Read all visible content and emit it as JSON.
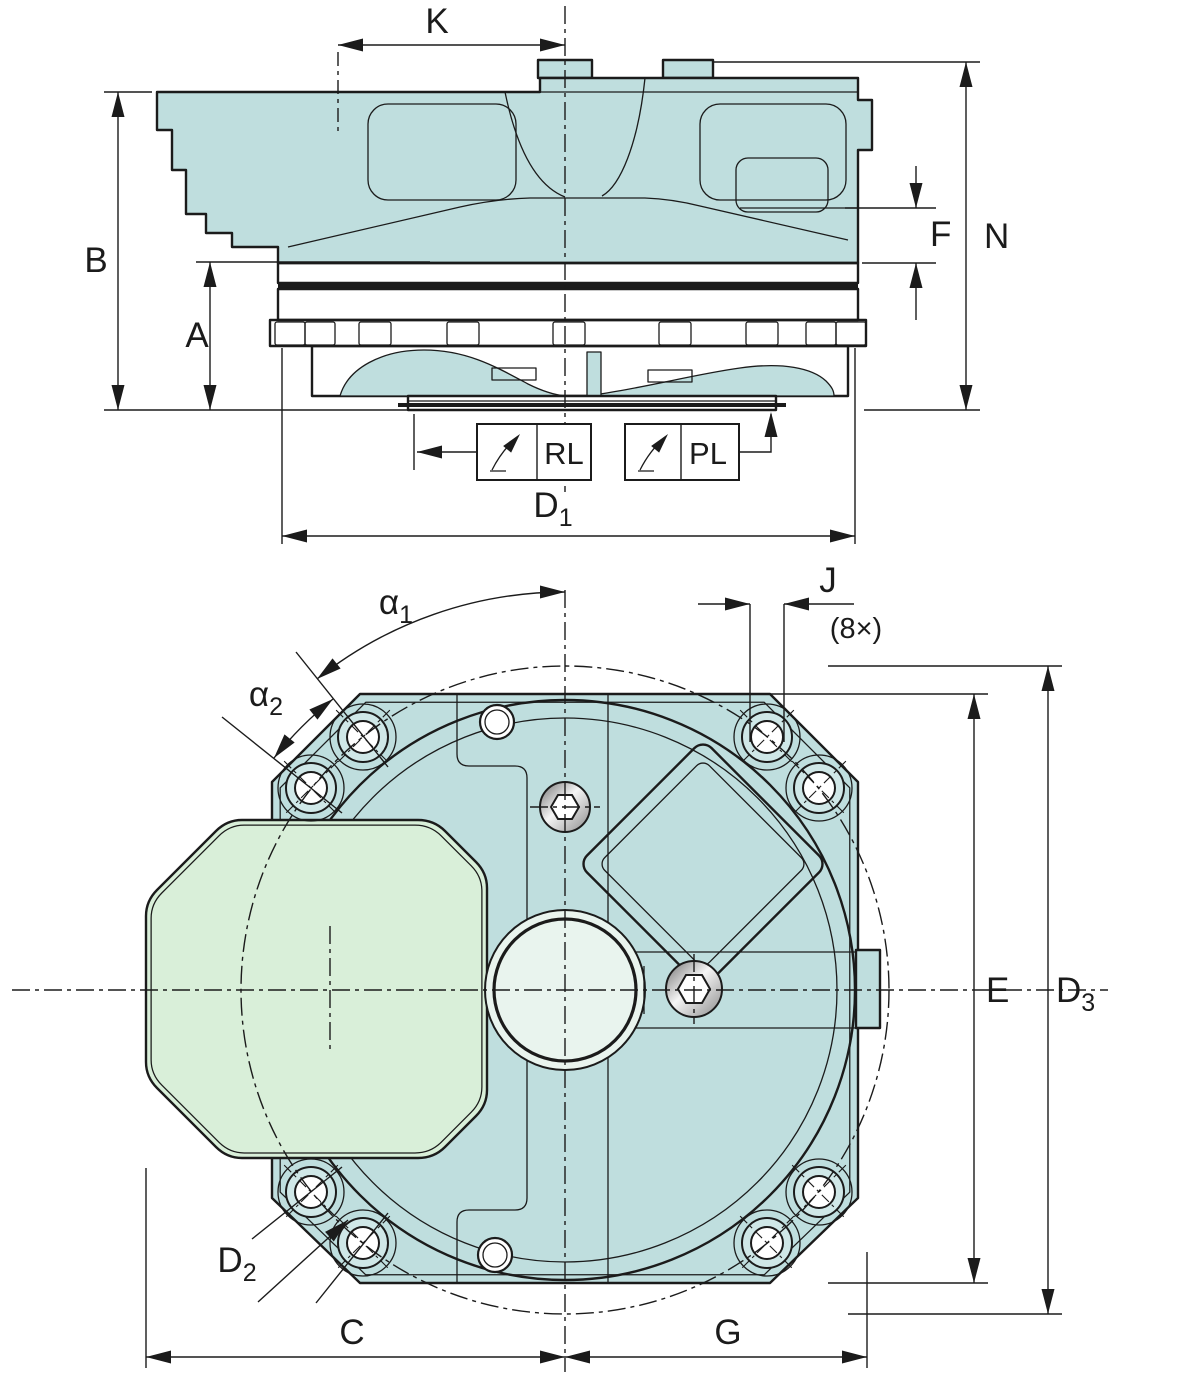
{
  "colors": {
    "line": "#1b1b1b",
    "body": "#bfdede",
    "green": "#d9efd9",
    "pale": "#e9f4ee",
    "bore": "#cfe7e7"
  },
  "side_view": {
    "dim_k": "K",
    "dim_b": "B",
    "dim_a": "A",
    "dim_f": "F",
    "dim_n": "N",
    "d1": {
      "base": "D",
      "sub": "1"
    },
    "callout_rl": "RL",
    "callout_pl": "PL"
  },
  "plan_view": {
    "alpha1": {
      "base": "α",
      "sub": "1"
    },
    "alpha2": {
      "base": "α",
      "sub": "2"
    },
    "dim_j": "J",
    "j_count": "(8×)",
    "dim_e": "E",
    "d3": {
      "base": "D",
      "sub": "3"
    },
    "d2": {
      "base": "D",
      "sub": "2"
    },
    "dim_c": "C",
    "dim_g": "G"
  }
}
